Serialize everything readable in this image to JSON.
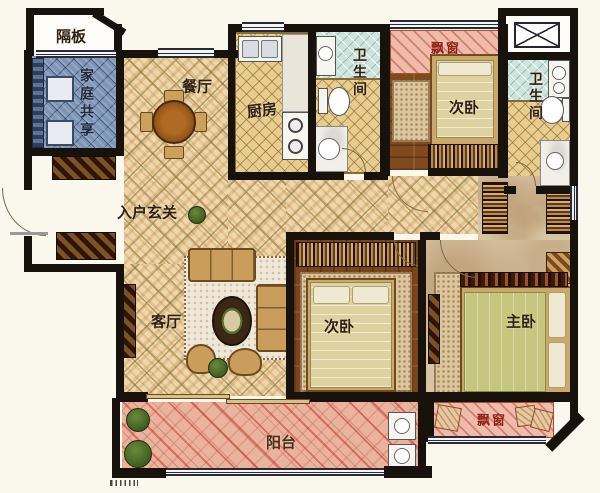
{
  "type": "apartment-floor-plan",
  "labels": {
    "partition": "隔板",
    "family_share": "家庭共享",
    "dining": "餐厅",
    "kitchen": "厨房",
    "bath_common": "卫生间",
    "bay_window_top": "飘窗",
    "bedroom_second_top": "次卧",
    "bath_master": "卫生间",
    "foyer": "入户玄关",
    "living": "客厅",
    "bedroom_second_mid": "次卧",
    "master_bedroom": "主卧",
    "bay_window_master": "飘窗",
    "balcony": "阳台"
  },
  "colors": {
    "wall": "#17120c",
    "tile": "#ecd8ab",
    "wood": "#7e4a1e",
    "blue_room": "#7e96b6",
    "balcony": "#eab39e",
    "bay": "#eebcab",
    "marble": "#d8c5a4",
    "label": "#2e1f10",
    "label_accent": "#8e2014",
    "background": "#faf7ec"
  }
}
